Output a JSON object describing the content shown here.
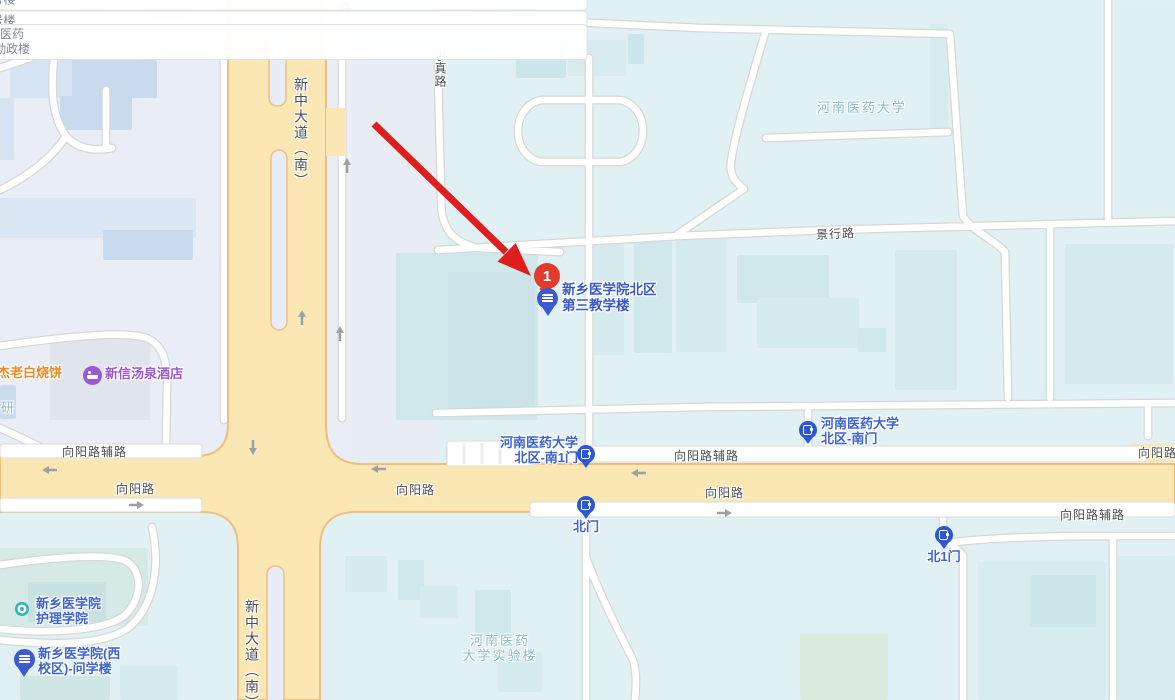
{
  "map": {
    "colors": {
      "campus-bg": "#e1f0f3",
      "district-bg": "#e9edf5",
      "mid-bg": "#e7edf3",
      "road-yellow": "#fae7b4",
      "road-yellow-border": "#f1bf7d",
      "road-white": "#ffffff",
      "road-casing": "#d6d7d9",
      "median-fill": "#e8ecf6",
      "road-label": "#4a4e55",
      "campus-label": "#8abaca",
      "poi-blue": "#3d63d1",
      "gate-blue": "#2e57d8",
      "metro-teal": "#2fb3be",
      "hotel-purple": "#9b59d0",
      "food-orange": "#ee8a1e",
      "marker-red": "#e23b2e",
      "arrow-red": "#df1e1e"
    },
    "road_labels": [
      {
        "text": "路",
        "x": 337,
        "y": 1,
        "vertical": true
      },
      {
        "text": "求真路",
        "x": 432,
        "y": 49,
        "vertical": true
      },
      {
        "text": "新中大道（南）",
        "x": 291,
        "y": 77,
        "vertical": true,
        "big": true
      },
      {
        "text": "新中大道（南）",
        "x": 242,
        "y": 599,
        "vertical": true,
        "big": true
      },
      {
        "text": "景行路",
        "x": 816,
        "y": 225,
        "rotate": -3
      },
      {
        "text": "向阳路辅路",
        "x": 62,
        "y": 443
      },
      {
        "text": "向阳路",
        "x": 116,
        "y": 480
      },
      {
        "text": "向阳路",
        "x": 396,
        "y": 481
      },
      {
        "text": "向阳路辅路",
        "x": 674,
        "y": 447
      },
      {
        "text": "向阳路",
        "x": 705,
        "y": 484
      },
      {
        "text": "向阳路辅路",
        "x": 1060,
        "y": 506
      },
      {
        "text": "向阳路辅路",
        "x": 1138,
        "y": 444
      }
    ],
    "building_labels": [
      {
        "lines": [
          "5号楼"
        ],
        "x": 113,
        "y": 125
      },
      {
        "lines": [
          "3号楼"
        ],
        "x": 48,
        "y": 250
      },
      {
        "lines": [
          "河南医药",
          "大学勤政楼"
        ],
        "x": 592,
        "y": 72
      }
    ],
    "campus_labels": [
      {
        "lines": [
          "河南医药大学"
        ],
        "x": 817,
        "y": 100
      },
      {
        "lines": [
          "河南医药",
          "大学实验楼"
        ],
        "x": 500,
        "y": 633,
        "center": true
      },
      {
        "lines": [
          "研"
        ],
        "x": 1,
        "y": 400
      }
    ],
    "pois": [
      {
        "name": "gate-beiqu-nan1men",
        "icon": "gate",
        "lines": [
          "河南医药大学",
          "北区-南1门"
        ],
        "layout": "left",
        "icon_x": 586,
        "icon_y": 454,
        "text_x": 578,
        "text_y": 435
      },
      {
        "name": "gate-beiqu-nanmen",
        "icon": "gate",
        "lines": [
          "河南医药大学",
          "北区-南门"
        ],
        "layout": "right",
        "icon_x": 808,
        "icon_y": 430,
        "text_x": 821,
        "text_y": 416
      },
      {
        "name": "gate-beimen",
        "icon": "gate",
        "lines": [
          "北门"
        ],
        "layout": "below",
        "icon_x": 586,
        "icon_y": 505,
        "text_x": 586,
        "text_y": 519
      },
      {
        "name": "gate-bei1men",
        "icon": "gate",
        "lines": [
          "北1门"
        ],
        "layout": "below",
        "icon_x": 944,
        "icon_y": 535,
        "text_x": 944,
        "text_y": 549
      },
      {
        "name": "nursing-college",
        "icon": "dot",
        "lines": [
          "新乡医学院",
          "护理学院"
        ],
        "layout": "right",
        "icon_x": 22,
        "icon_y": 609,
        "text_x": 36,
        "text_y": 596
      },
      {
        "name": "wenxue-building",
        "icon": "pin",
        "lines": [
          "新乡医学院(西",
          "校区)-问学楼"
        ],
        "layout": "right",
        "icon_x": 24,
        "icon_y": 659,
        "text_x": 38,
        "text_y": 646
      },
      {
        "name": "xinxin-hotspring-hotel",
        "icon": "hotel",
        "lines": [
          "新信汤泉酒店"
        ],
        "layout": "right",
        "color": "purple",
        "icon_x": 92,
        "icon_y": 375,
        "text_x": 105,
        "text_y": 366
      },
      {
        "name": "laobai-shaobing",
        "icon": null,
        "lines": [
          "杰老白烧饼"
        ],
        "layout": "plain",
        "color": "orange",
        "text_x": -3,
        "text_y": 365
      }
    ],
    "marker": {
      "badge": "1",
      "lines": [
        "新乡医学院北区",
        "第三教学楼"
      ],
      "pin_x": 548,
      "pin_y": 299,
      "badge_x": 547,
      "badge_y": 276,
      "text_x": 562,
      "text_y": 282
    }
  }
}
